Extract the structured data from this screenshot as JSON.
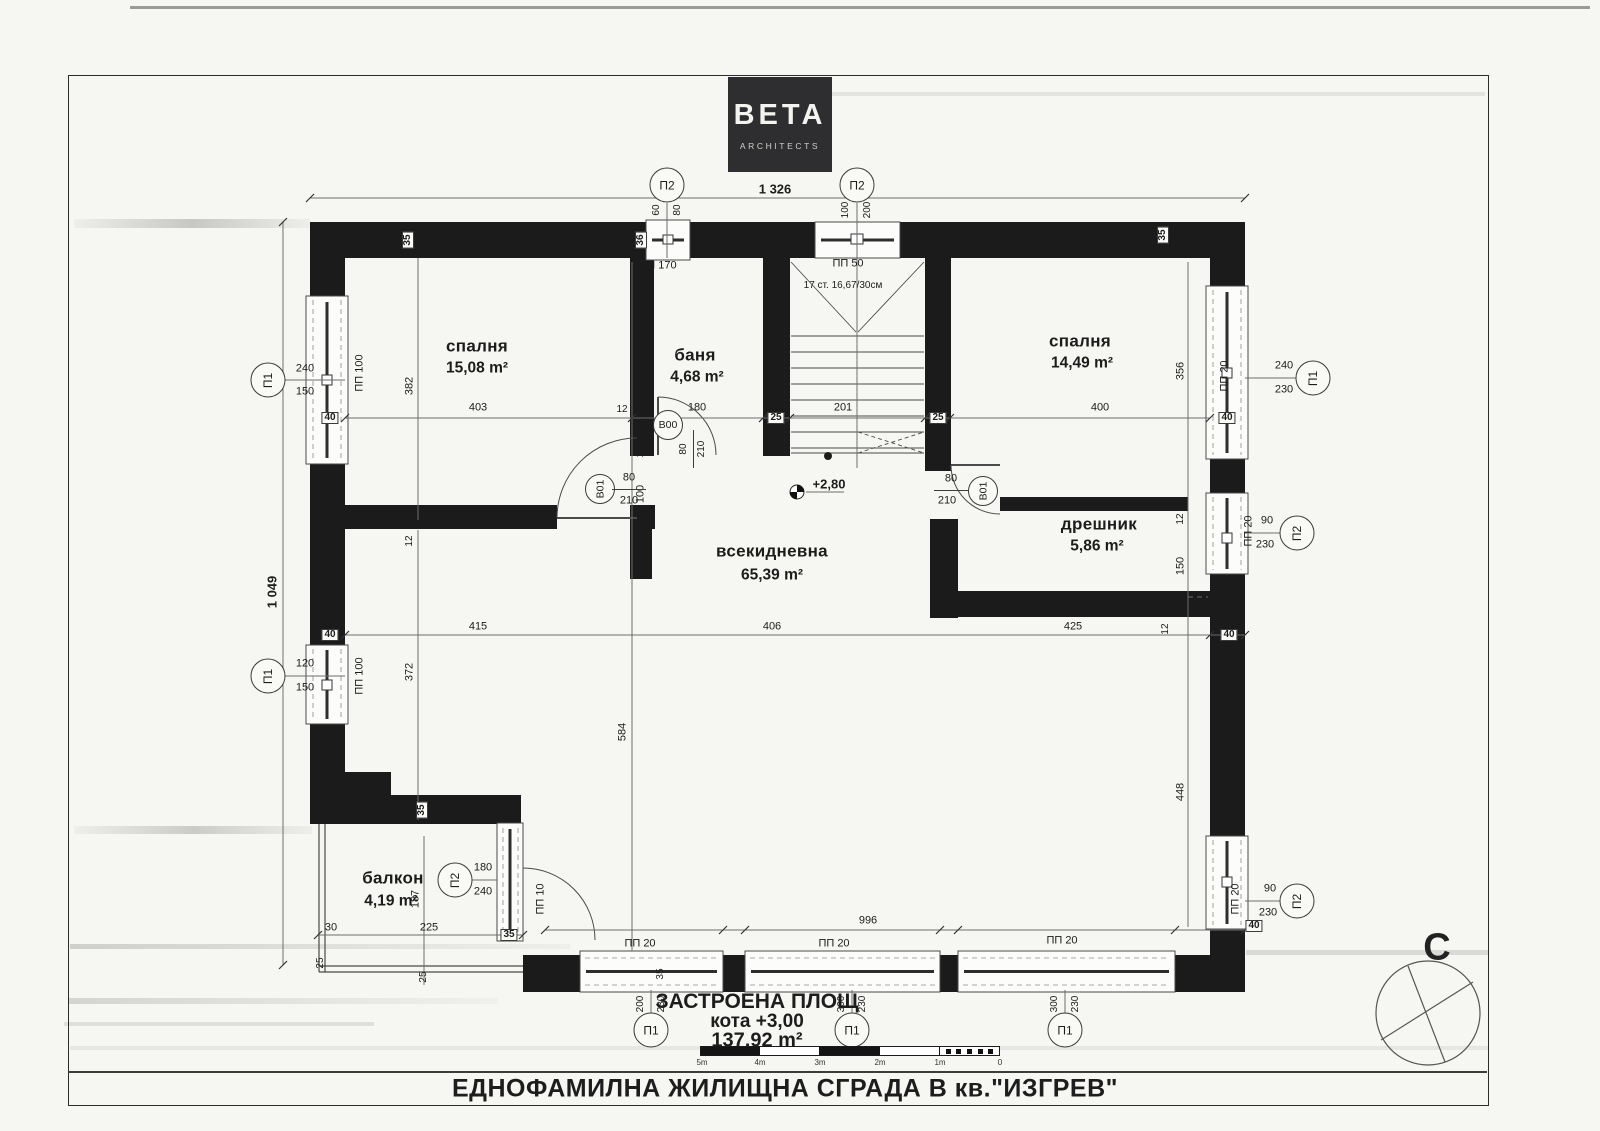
{
  "logo": {
    "brand": "BETA",
    "tagline": "ARCHITECTS"
  },
  "sheet": {
    "title": "ЕДНОФАМИЛНА ЖИЛИЩНА СГРАДА В кв.\"ИЗГРЕВ\"",
    "north": "С"
  },
  "area_block": {
    "line1": "ЗАСТРОЕНА ПЛОЩ",
    "line2": "кота +3,00",
    "line3": "137,92 m²"
  },
  "level_mark": "+2,80",
  "stairs_note": "17 ст. 16,67/30см",
  "axes": {
    "p1": "П1",
    "p2": "П2"
  },
  "door_tags": {
    "b00": "В00",
    "b01": "В01"
  },
  "door_size": {
    "w": "80",
    "h": "210"
  },
  "windows": {
    "pp170": "ПП 170",
    "pp50": "ПП 50",
    "pp100": "ПП 100",
    "pp20": "ПП 20",
    "pp10": "ПП 10"
  },
  "rooms": {
    "bedroom1": {
      "name": "спалня",
      "area": "15,08 m²"
    },
    "bath": {
      "name": "баня",
      "area": "4,68 m²"
    },
    "bedroom2": {
      "name": "спалня",
      "area": "14,49 m²"
    },
    "dresser": {
      "name": "дрешник",
      "area": "5,86 m²"
    },
    "living": {
      "name": "всекидневна",
      "area": "65,39 m²"
    },
    "balcony": {
      "name": "балкон",
      "area": "4,19 m²"
    }
  },
  "scalebar": {
    "labels": [
      "5m",
      "4m",
      "3m",
      "2m",
      "1m",
      "0"
    ]
  },
  "dims": {
    "total_w": "1 326",
    "total_h": "1 049",
    "p2a": {
      "a": "60",
      "b": "80"
    },
    "p2b": {
      "a": "100",
      "b": "200"
    },
    "p1l1": {
      "a": "240",
      "b": "150"
    },
    "p1l2": {
      "a": "120",
      "b": "150"
    },
    "p1r": {
      "a": "240",
      "b": "230"
    },
    "p2r1": {
      "a": "90",
      "b": "230"
    },
    "p2r2": {
      "a": "90",
      "b": "230"
    },
    "p2balc": {
      "a": "180",
      "b": "240"
    },
    "p1b1": {
      "a": "200",
      "b": "230"
    },
    "p1b2": {
      "a": "300",
      "b": "230"
    },
    "p1b3": {
      "a": "300",
      "b": "230"
    },
    "row1": [
      "403",
      "180",
      "201",
      "400"
    ],
    "row2": [
      "415",
      "406",
      "425"
    ],
    "v382": "382",
    "v270": "270",
    "v356": "356",
    "v372": "372",
    "v584": "584",
    "v448": "448",
    "v187": "187",
    "v100": "100",
    "v150": "150",
    "w12": "12",
    "w40": "40",
    "w35": "35",
    "w36": "36",
    "w25": "25",
    "w30": "30",
    "b996": "996",
    "b225": "225"
  }
}
